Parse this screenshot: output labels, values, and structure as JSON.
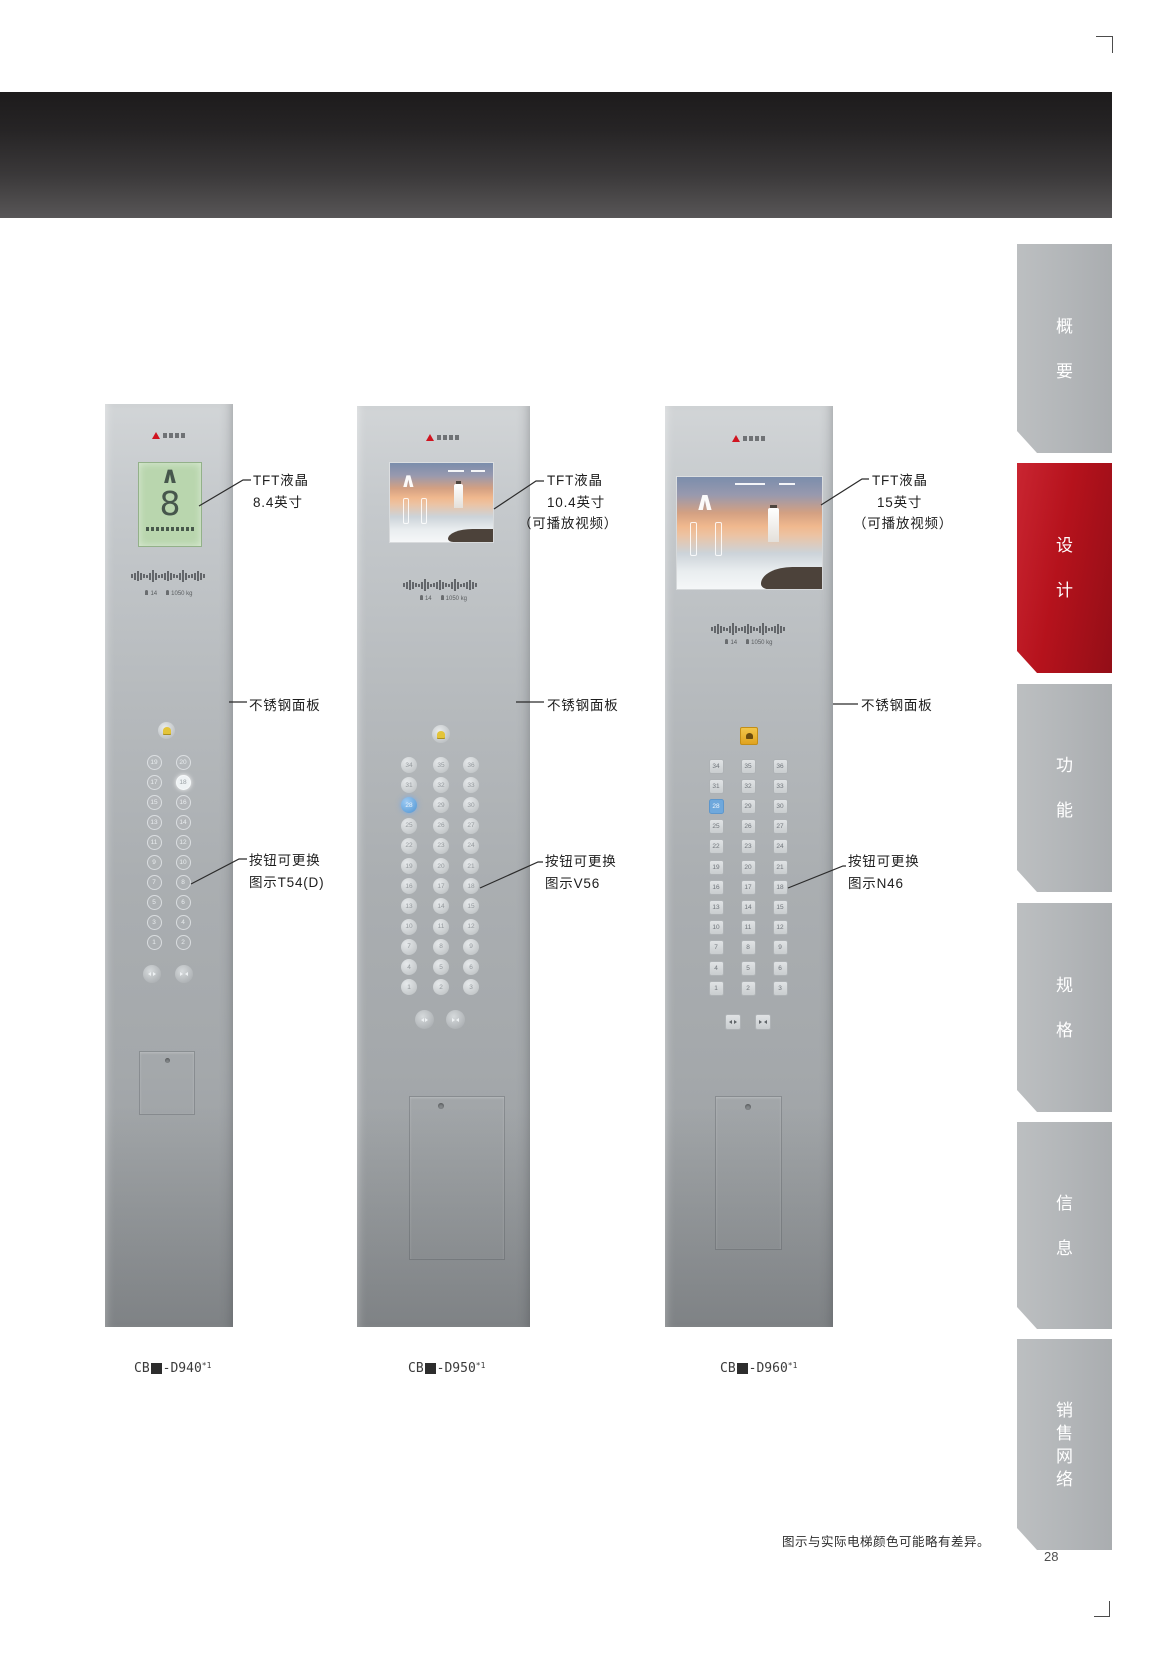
{
  "page": {
    "number": "28",
    "footnote": "图示与实际电梯颜色可能略有差异。"
  },
  "sidebar": {
    "tabs": [
      {
        "label": "概要",
        "active": false
      },
      {
        "label": "设计",
        "active": true
      },
      {
        "label": "功能",
        "active": false
      },
      {
        "label": "规格",
        "active": false
      },
      {
        "label": "信息",
        "active": false
      },
      {
        "label": "销售网络",
        "active": false
      }
    ]
  },
  "colors": {
    "accent_red": "#b5121c",
    "tab_gray": "#b4b7b9",
    "band_top": "#1d1b1c",
    "band_bottom": "#585657",
    "highlight_blue": "#6fa8dc",
    "alarm_yellow": "#e3c43a",
    "alarm_orange": "#e8a829"
  },
  "icons": {
    "door_open": "triangles pointing outward",
    "door_close": "triangles pointing inward",
    "alarm": "bell",
    "brand_mark": "red three-diamond"
  },
  "panels": [
    {
      "caption": {
        "prefix": "CB",
        "model": "-D940",
        "note": "*1"
      },
      "display": {
        "arrow": "∧",
        "floor": "8"
      },
      "capacity": {
        "persons": "14",
        "load": "1050 kg"
      },
      "annotations": {
        "display": [
          "TFT液晶",
          "8.4英寸"
        ],
        "panel": [
          "不锈钢面板"
        ],
        "buttons": [
          "按钮可更换",
          "图示T54(D)"
        ]
      },
      "buttons": {
        "highlight": "18",
        "rows": [
          [
            "19",
            "20"
          ],
          [
            "17",
            "18"
          ],
          [
            "15",
            "16"
          ],
          [
            "13",
            "14"
          ],
          [
            "11",
            "12"
          ],
          [
            "9",
            "10"
          ],
          [
            "7",
            "8"
          ],
          [
            "5",
            "6"
          ],
          [
            "3",
            "4"
          ],
          [
            "1",
            "2"
          ]
        ]
      }
    },
    {
      "caption": {
        "prefix": "CB",
        "model": "-D950",
        "note": "*1"
      },
      "display": {
        "arrow": "∧"
      },
      "capacity": {
        "persons": "14",
        "load": "1050 kg"
      },
      "annotations": {
        "display": [
          "TFT液晶",
          "10.4英寸",
          "（可播放视频）"
        ],
        "panel": [
          "不锈钢面板"
        ],
        "buttons": [
          "按钮可更换",
          "图示V56"
        ]
      },
      "buttons": {
        "highlight": "28",
        "rows": [
          [
            "34",
            "35",
            "36"
          ],
          [
            "31",
            "32",
            "33"
          ],
          [
            "28",
            "29",
            "30"
          ],
          [
            "25",
            "26",
            "27"
          ],
          [
            "22",
            "23",
            "24"
          ],
          [
            "19",
            "20",
            "21"
          ],
          [
            "16",
            "17",
            "18"
          ],
          [
            "13",
            "14",
            "15"
          ],
          [
            "10",
            "11",
            "12"
          ],
          [
            "7",
            "8",
            "9"
          ],
          [
            "4",
            "5",
            "6"
          ],
          [
            "1",
            "2",
            "3"
          ]
        ]
      }
    },
    {
      "caption": {
        "prefix": "CB",
        "model": "-D960",
        "note": "*1"
      },
      "display": {
        "arrow": "∧"
      },
      "capacity": {
        "persons": "14",
        "load": "1050 kg"
      },
      "annotations": {
        "display": [
          "TFT液晶",
          "15英寸",
          "（可播放视频）"
        ],
        "panel": [
          "不锈钢面板"
        ],
        "buttons": [
          "按钮可更换",
          "图示N46"
        ]
      },
      "buttons": {
        "highlight": "28",
        "rows": [
          [
            "34",
            "35",
            "36"
          ],
          [
            "31",
            "32",
            "33"
          ],
          [
            "28",
            "29",
            "30"
          ],
          [
            "25",
            "26",
            "27"
          ],
          [
            "22",
            "23",
            "24"
          ],
          [
            "19",
            "20",
            "21"
          ],
          [
            "16",
            "17",
            "18"
          ],
          [
            "13",
            "14",
            "15"
          ],
          [
            "10",
            "11",
            "12"
          ],
          [
            "7",
            "8",
            "9"
          ],
          [
            "4",
            "5",
            "6"
          ],
          [
            "1",
            "2",
            "3"
          ]
        ]
      }
    }
  ]
}
